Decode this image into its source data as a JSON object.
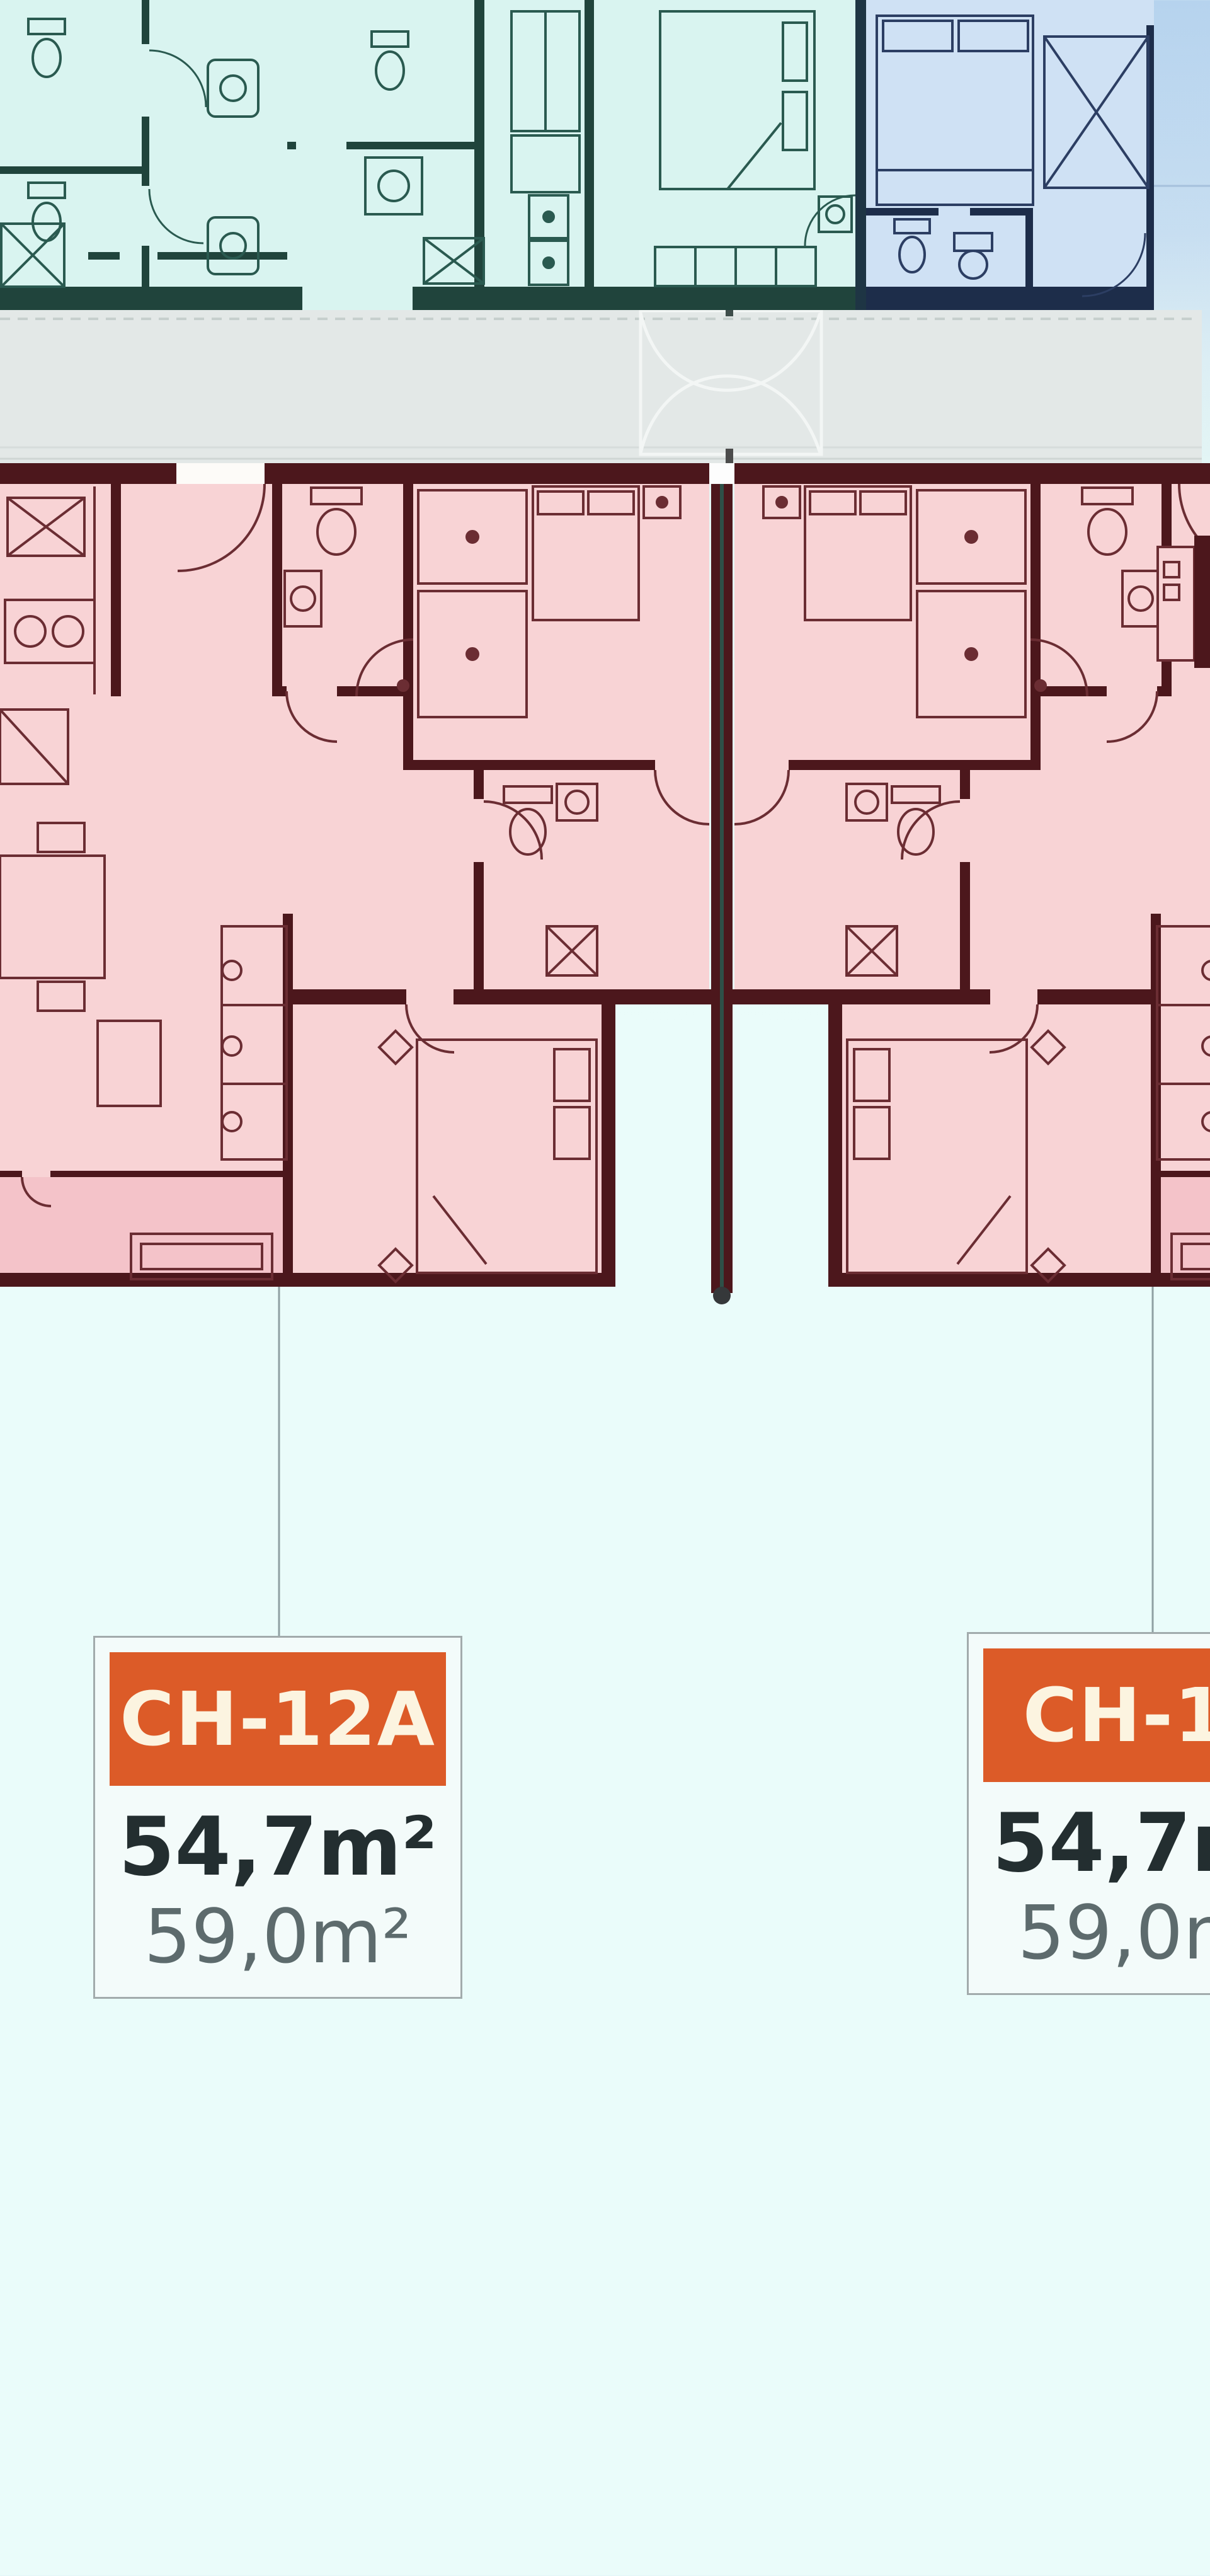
{
  "floorplan": {
    "units": [
      {
        "code": "CH-12A",
        "area_construction": "54,7m²",
        "area_total": "59,0m²"
      },
      {
        "code": "CH-15",
        "area_construction": "54,7m²",
        "area_total": "59,0m²"
      }
    ],
    "icons": [
      "stairs-icon",
      "toilet-icon",
      "sink-icon",
      "shower-icon",
      "bed-icon",
      "sofa-icon",
      "wardrobe-icon",
      "stove-icon",
      "fridge-icon",
      "dining-table-icon",
      "washer-icon",
      "door-arc-icon"
    ]
  },
  "colors": {
    "bg-top": "#b6d3ee",
    "bg-bottom": "#eafcfa",
    "teal-fill": "#d9f4f0",
    "teal-wall": "#20443c",
    "blue-fill": "#cfe1f4",
    "blue-wall": "#1d2d4a",
    "blue-line": "#2c3e63",
    "corridor-fill": "#e3e8e7",
    "corridor-line": "#c6cfcd",
    "stairs-line": "#f3f6f5",
    "pink-fill": "#f8d3d5",
    "pink-balcony": "#f4c3c9",
    "pink-wall": "#4c171c",
    "pink-line": "#6b2d33",
    "party-line": "#2e5048",
    "gap-white": "#fdfbf8",
    "connector": "#8fa0a3",
    "card-bg": "#f3fbfa",
    "card-border": "#a2abac",
    "badge-bg": "#dc5b28",
    "badge-text": "#fcf4e0",
    "area-main": "#232e30",
    "area-sub": "#5d6b6d"
  }
}
